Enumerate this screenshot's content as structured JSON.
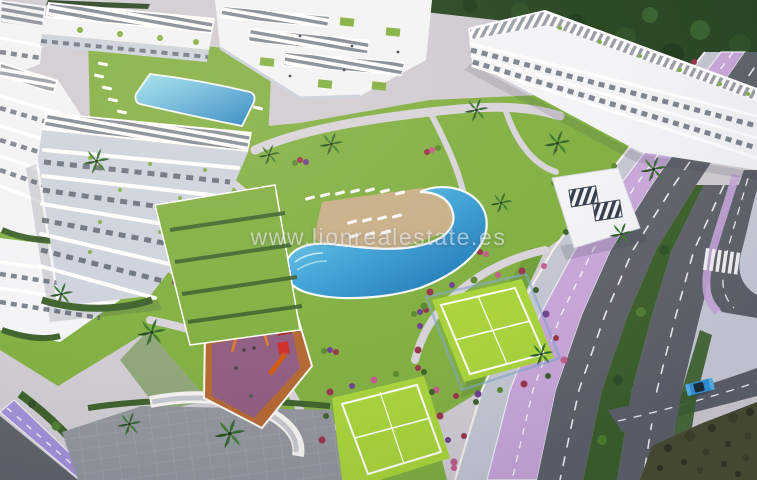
{
  "watermark": {
    "text": "www.lionrealestate.es"
  },
  "palette": {
    "lawn": "#7fae3e",
    "lawnDark": "#55862c",
    "court": "#a8d438",
    "trees": "#24421f",
    "hedge": "#3a5e28",
    "poolDeep": "#1878bc",
    "poolMid": "#3aa4da",
    "poolLight": "#85d6ec",
    "deck": "#c6ae85",
    "building": "#f3f4f7",
    "buildingShade": "#ccd2de",
    "glass": "#46505e",
    "solar": "#2c3849",
    "road": "#5c6068",
    "sidewalk": "#c9cdd8",
    "bike": "#c7a6da",
    "bikeBL": "#9f8fd8",
    "scrub": "#474b30",
    "plaza": "#8f939b",
    "playSurface": "#b2652e",
    "playShade": "#6a4fd0",
    "carBlue": "#2f96dd",
    "flowerRed": "#993047",
    "flowerPurple": "#6a3d8f",
    "flowerPink": "#c05a8a"
  }
}
